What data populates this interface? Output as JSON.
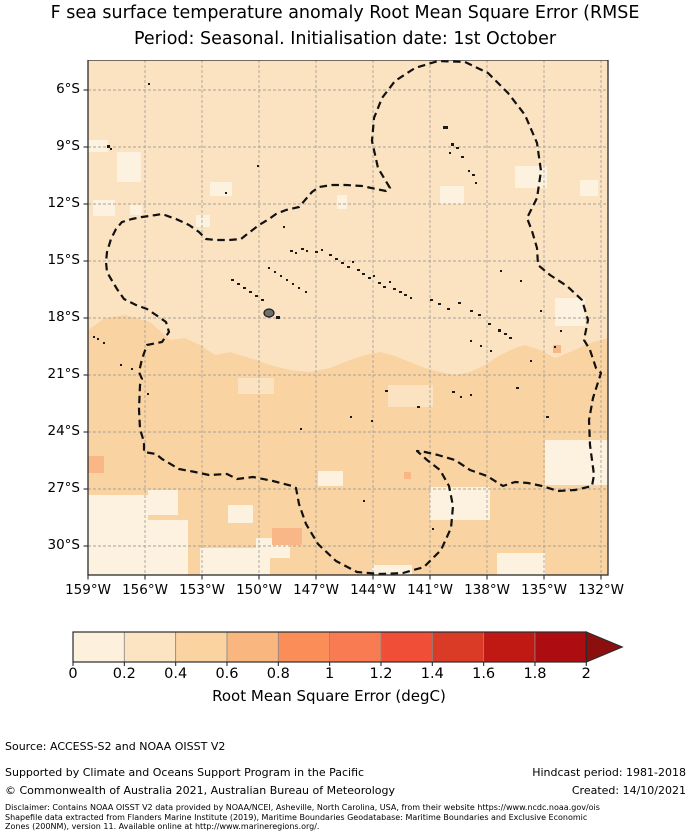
{
  "title": {
    "line1": "F sea surface temperature anomaly Root Mean Square Error (RMSE",
    "line2": "Period: Seasonal. Initialisation date: 1st October"
  },
  "map": {
    "x_tick_labels": [
      "159°W",
      "156°W",
      "153°W",
      "150°W",
      "147°W",
      "144°W",
      "141°W",
      "138°W",
      "135°W",
      "132°W"
    ],
    "y_tick_labels": [
      "6°S",
      "9°S",
      "12°S",
      "15°S",
      "18°S",
      "21°S",
      "24°S",
      "27°S",
      "30°S"
    ],
    "colors": {
      "base": "#FBE3C2",
      "south": "#FAD3A3",
      "light": "#FDF1DF",
      "salmon": "#F9B687",
      "grid": "#A8A39A",
      "border": "#2B2B2B",
      "island": "#1A1A1A",
      "tahiti_fill": "#6F6F6F",
      "eez": "#111111"
    },
    "south_region": [
      [
        0,
        270
      ],
      [
        17,
        258
      ],
      [
        37,
        255
      ],
      [
        62,
        262
      ],
      [
        82,
        280
      ],
      [
        97,
        278
      ],
      [
        112,
        285
      ],
      [
        127,
        295
      ],
      [
        142,
        292
      ],
      [
        162,
        298
      ],
      [
        182,
        305
      ],
      [
        202,
        310
      ],
      [
        222,
        312
      ],
      [
        242,
        308
      ],
      [
        262,
        300
      ],
      [
        277,
        295
      ],
      [
        292,
        292
      ],
      [
        307,
        296
      ],
      [
        322,
        302
      ],
      [
        337,
        308
      ],
      [
        352,
        312
      ],
      [
        367,
        315
      ],
      [
        382,
        312
      ],
      [
        397,
        305
      ],
      [
        412,
        295
      ],
      [
        427,
        288
      ],
      [
        437,
        285
      ],
      [
        452,
        290
      ],
      [
        467,
        298
      ],
      [
        482,
        292
      ],
      [
        497,
        285
      ],
      [
        512,
        280
      ],
      [
        520,
        278
      ],
      [
        520,
        515
      ],
      [
        0,
        515
      ]
    ],
    "light_patches": [
      [
        29,
        92,
        24,
        30
      ],
      [
        5,
        140,
        22,
        16
      ],
      [
        42,
        145,
        12,
        10
      ],
      [
        122,
        122,
        22,
        14
      ],
      [
        352,
        126,
        24,
        18
      ],
      [
        427,
        106,
        32,
        22
      ],
      [
        108,
        155,
        14,
        12
      ],
      [
        0,
        435,
        60,
        80
      ],
      [
        60,
        460,
        40,
        55
      ],
      [
        112,
        488,
        70,
        27
      ],
      [
        168,
        478,
        34,
        20
      ],
      [
        342,
        427,
        60,
        33
      ],
      [
        457,
        380,
        63,
        45
      ],
      [
        409,
        493,
        48,
        22
      ],
      [
        284,
        505,
        40,
        10
      ],
      [
        230,
        411,
        25,
        15
      ],
      [
        467,
        238,
        30,
        28
      ],
      [
        0,
        80,
        20,
        12
      ],
      [
        249,
        135,
        10,
        14
      ],
      [
        492,
        120,
        18,
        16
      ],
      [
        60,
        430,
        30,
        25
      ],
      [
        140,
        445,
        25,
        18
      ]
    ],
    "base_patches": [
      [
        300,
        325,
        45,
        22
      ],
      [
        150,
        318,
        36,
        16
      ]
    ],
    "salmon_patches": [
      [
        0,
        396,
        16,
        17
      ],
      [
        184,
        468,
        30,
        17
      ],
      [
        316,
        412,
        7,
        7
      ],
      [
        465,
        285,
        8,
        8
      ]
    ],
    "tahiti": [
      176,
      249,
      10,
      8
    ],
    "islands": [
      [
        355,
        66,
        5,
        3
      ],
      [
        363,
        83,
        3,
        3
      ],
      [
        368,
        87,
        3,
        2
      ],
      [
        361,
        92,
        2,
        2
      ],
      [
        373,
        96,
        3,
        2
      ],
      [
        380,
        110,
        2,
        2
      ],
      [
        384,
        114,
        3,
        2
      ],
      [
        387,
        122,
        2,
        2
      ],
      [
        60,
        23,
        2,
        2
      ],
      [
        19,
        85,
        3,
        3
      ],
      [
        22,
        88,
        2,
        2
      ],
      [
        169,
        105,
        2,
        2
      ],
      [
        137,
        132,
        2,
        2
      ],
      [
        195,
        166,
        2,
        2
      ],
      [
        202,
        190,
        3,
        2
      ],
      [
        207,
        192,
        2,
        2
      ],
      [
        213,
        188,
        3,
        2
      ],
      [
        218,
        190,
        2,
        2
      ],
      [
        227,
        191,
        3,
        2
      ],
      [
        233,
        189,
        2,
        2
      ],
      [
        241,
        194,
        3,
        2
      ],
      [
        247,
        198,
        3,
        2
      ],
      [
        253,
        202,
        3,
        2
      ],
      [
        259,
        206,
        3,
        2
      ],
      [
        264,
        201,
        2,
        2
      ],
      [
        269,
        209,
        3,
        2
      ],
      [
        274,
        213,
        3,
        2
      ],
      [
        280,
        217,
        3,
        2
      ],
      [
        285,
        215,
        2,
        2
      ],
      [
        290,
        222,
        3,
        2
      ],
      [
        295,
        226,
        3,
        2
      ],
      [
        301,
        221,
        2,
        2
      ],
      [
        305,
        228,
        3,
        2
      ],
      [
        311,
        231,
        3,
        2
      ],
      [
        316,
        234,
        3,
        2
      ],
      [
        322,
        237,
        2,
        2
      ],
      [
        342,
        239,
        3,
        2
      ],
      [
        350,
        243,
        3,
        2
      ],
      [
        359,
        248,
        3,
        2
      ],
      [
        370,
        242,
        3,
        2
      ],
      [
        382,
        250,
        3,
        2
      ],
      [
        390,
        254,
        3,
        2
      ],
      [
        400,
        263,
        3,
        2
      ],
      [
        410,
        269,
        3,
        3
      ],
      [
        416,
        273,
        3,
        2
      ],
      [
        421,
        277,
        3,
        2
      ],
      [
        143,
        219,
        3,
        2
      ],
      [
        149,
        223,
        3,
        2
      ],
      [
        155,
        227,
        3,
        2
      ],
      [
        161,
        231,
        3,
        2
      ],
      [
        167,
        235,
        3,
        2
      ],
      [
        173,
        239,
        3,
        2
      ],
      [
        188,
        256,
        4,
        3
      ],
      [
        180,
        207,
        2,
        2
      ],
      [
        186,
        211,
        2,
        2
      ],
      [
        192,
        215,
        2,
        2
      ],
      [
        198,
        219,
        2,
        2
      ],
      [
        204,
        223,
        2,
        2
      ],
      [
        210,
        227,
        2,
        2
      ],
      [
        217,
        231,
        2,
        2
      ],
      [
        297,
        330,
        3,
        2
      ],
      [
        329,
        346,
        3,
        2
      ],
      [
        364,
        331,
        3,
        2
      ],
      [
        372,
        336,
        2,
        2
      ],
      [
        382,
        334,
        2,
        2
      ],
      [
        428,
        327,
        3,
        2
      ],
      [
        458,
        356,
        3,
        2
      ],
      [
        262,
        356,
        2,
        2
      ],
      [
        283,
        360,
        2,
        2
      ],
      [
        212,
        368,
        2,
        2
      ],
      [
        275,
        440,
        2,
        2
      ],
      [
        344,
        468,
        2,
        2
      ],
      [
        9,
        278,
        2,
        2
      ],
      [
        15,
        282,
        2,
        2
      ],
      [
        5,
        276,
        2,
        2
      ],
      [
        59,
        333,
        2,
        2
      ],
      [
        32,
        304,
        2,
        2
      ],
      [
        43,
        308,
        2,
        2
      ],
      [
        412,
        210,
        2,
        2
      ],
      [
        432,
        220,
        2,
        2
      ],
      [
        452,
        250,
        2,
        2
      ],
      [
        472,
        270,
        2,
        2
      ],
      [
        382,
        280,
        2,
        2
      ],
      [
        392,
        285,
        2,
        2
      ],
      [
        402,
        290,
        2,
        2
      ],
      [
        442,
        300,
        2,
        2
      ],
      [
        466,
        286,
        2,
        2
      ]
    ],
    "eez_boundary": [
      [
        302,
        128
      ],
      [
        290,
        108
      ],
      [
        284,
        81
      ],
      [
        286,
        58
      ],
      [
        294,
        38
      ],
      [
        307,
        21
      ],
      [
        327,
        8
      ],
      [
        350,
        1
      ],
      [
        377,
        2
      ],
      [
        400,
        13
      ],
      [
        420,
        33
      ],
      [
        437,
        55
      ],
      [
        449,
        83
      ],
      [
        453,
        111
      ],
      [
        449,
        138
      ],
      [
        439,
        158
      ],
      [
        444,
        171
      ],
      [
        449,
        188
      ],
      [
        450,
        205
      ],
      [
        462,
        215
      ],
      [
        479,
        226
      ],
      [
        494,
        240
      ],
      [
        500,
        260
      ],
      [
        496,
        280
      ],
      [
        502,
        290
      ],
      [
        508,
        308
      ],
      [
        513,
        313
      ],
      [
        505,
        338
      ],
      [
        501,
        360
      ],
      [
        502,
        385
      ],
      [
        506,
        415
      ],
      [
        504,
        426
      ],
      [
        487,
        430
      ],
      [
        470,
        431
      ],
      [
        454,
        426
      ],
      [
        440,
        423
      ],
      [
        427,
        422
      ],
      [
        415,
        426
      ],
      [
        399,
        416
      ],
      [
        382,
        410
      ],
      [
        367,
        400
      ],
      [
        350,
        395
      ],
      [
        337,
        392
      ],
      [
        329,
        391
      ],
      [
        339,
        400
      ],
      [
        352,
        410
      ],
      [
        361,
        426
      ],
      [
        365,
        446
      ],
      [
        363,
        468
      ],
      [
        353,
        490
      ],
      [
        336,
        507
      ],
      [
        315,
        513
      ],
      [
        292,
        514
      ],
      [
        269,
        512
      ],
      [
        248,
        501
      ],
      [
        230,
        484
      ],
      [
        218,
        464
      ],
      [
        211,
        444
      ],
      [
        208,
        428
      ],
      [
        204,
        426
      ],
      [
        185,
        421
      ],
      [
        165,
        417
      ],
      [
        149,
        419
      ],
      [
        139,
        414
      ],
      [
        121,
        415
      ],
      [
        107,
        412
      ],
      [
        91,
        409
      ],
      [
        74,
        399
      ],
      [
        68,
        394
      ],
      [
        56,
        392
      ],
      [
        56,
        382
      ],
      [
        52,
        369
      ],
      [
        51,
        349
      ],
      [
        52,
        325
      ],
      [
        54,
        319
      ],
      [
        51,
        312
      ],
      [
        54,
        299
      ],
      [
        59,
        285
      ],
      [
        74,
        282
      ],
      [
        81,
        272
      ],
      [
        78,
        262
      ],
      [
        68,
        255
      ],
      [
        59,
        249
      ],
      [
        48,
        245
      ],
      [
        36,
        239
      ],
      [
        29,
        229
      ],
      [
        23,
        219
      ],
      [
        19,
        212
      ],
      [
        18,
        202
      ],
      [
        19,
        192
      ],
      [
        23,
        179
      ],
      [
        28,
        169
      ],
      [
        34,
        162
      ],
      [
        44,
        159
      ],
      [
        54,
        157
      ],
      [
        68,
        155
      ],
      [
        74,
        154
      ],
      [
        88,
        159
      ],
      [
        101,
        165
      ],
      [
        111,
        172
      ],
      [
        118,
        179
      ],
      [
        128,
        180
      ],
      [
        141,
        180
      ],
      [
        153,
        179
      ],
      [
        158,
        175
      ],
      [
        171,
        165
      ],
      [
        181,
        159
      ],
      [
        188,
        154
      ],
      [
        198,
        150
      ],
      [
        211,
        147
      ],
      [
        224,
        132
      ],
      [
        231,
        127
      ],
      [
        244,
        125
      ],
      [
        258,
        125
      ],
      [
        274,
        126
      ],
      [
        288,
        129
      ],
      [
        298,
        131
      ]
    ]
  },
  "colorbar": {
    "ticks": [
      "0",
      "0.2",
      "0.4",
      "0.6",
      "0.8",
      "1",
      "1.2",
      "1.4",
      "1.6",
      "1.8",
      "2"
    ],
    "bin_colors": [
      "#FDF0DC",
      "#FCE4C2",
      "#FBD3A0",
      "#FAB67F",
      "#FB8D59",
      "#F87B52",
      "#F04E37",
      "#DA3B26",
      "#C01813",
      "#AD0C10"
    ],
    "arrow_color": "#8C0F10",
    "border_color": "#2B2B2B",
    "divider_color": "#8A8A8A",
    "label": "Root Mean Square Error (degC)"
  },
  "footer": {
    "source": "Source: ACCESS-S2 and NOAA OISST V2",
    "supported": "Supported by Climate and Oceans Support Program in the Pacific",
    "copyright": "© Commonwealth of Australia 2021, Australian Bureau of Meteorology",
    "hindcast": "Hindcast period: 1981-2018",
    "created": "Created: 14/10/2021",
    "disclaimer_line1": "Disclaimer: Contains NOAA OISST V2 data provided by NOAA/NCEI, Asheville, North Carolina, USA, from their website https://www.ncdc.noaa.gov/ois",
    "disclaimer_line2": "Shapefile data extracted from Flanders Marine Institute (2019), Maritime Boundaries Geodatabase: Maritime Boundaries and Exclusive Economic",
    "disclaimer_line3": "Zones (200NM), version 11. Available online at http://www.marineregions.org/."
  },
  "chart_data": {
    "type": "heatmap",
    "title": "F sea surface temperature anomaly Root Mean Square Error (RMSE",
    "subtitle": "Period: Seasonal. Initialisation date: 1st October",
    "xlabel": "",
    "ylabel": "",
    "x_ticks": [
      "159°W",
      "156°W",
      "153°W",
      "150°W",
      "147°W",
      "144°W",
      "141°W",
      "138°W",
      "135°W",
      "132°W"
    ],
    "y_ticks": [
      "6°S",
      "9°S",
      "12°S",
      "15°S",
      "18°S",
      "21°S",
      "24°S",
      "27°S",
      "30°S"
    ],
    "grid": true,
    "colorbar_label": "Root Mean Square Error (degC)",
    "colorbar_ticks": [
      0,
      0.2,
      0.4,
      0.6,
      0.8,
      1,
      1.2,
      1.4,
      1.6,
      1.8,
      2
    ],
    "colorbar_extend": "max",
    "units": "degC",
    "value_field_summary": {
      "north_of_18S_approx": "0.2-0.4",
      "south_of_18S_approx": "0.4-0.6",
      "lightest_patches_approx": "0-0.2",
      "isolated_warm_patches_approx": "0.6-0.8"
    },
    "overlay": "French Polynesia EEZ dashed boundary with island landmasses (Marquesas, Tuamotu, Society incl. Tahiti, Austral, Gambier)"
  }
}
